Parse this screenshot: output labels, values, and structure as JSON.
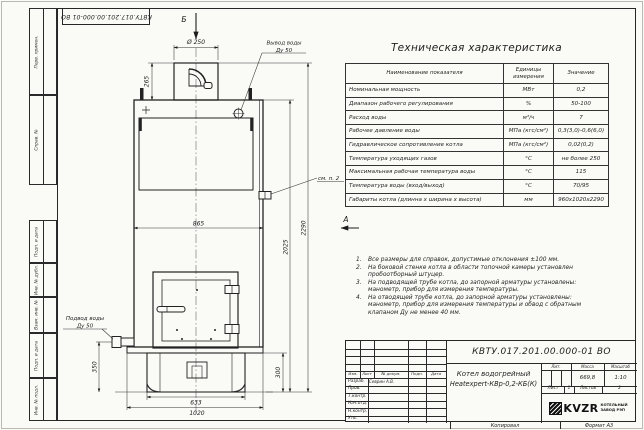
{
  "sheet": {
    "stamp_number": "КВТУ.017.201.00.000-01 ВО",
    "copied_label": "Копировал",
    "format_label": "Формат А3",
    "frame_fields": [
      "Перв. примен.",
      "Справ. №",
      "Подп. и дата",
      "Инв. № дубл.",
      "Взам. инв. №",
      "Подп. и дата",
      "Инв. № подл."
    ]
  },
  "drawing": {
    "view_b": "Б",
    "view_a": "А",
    "outlet_line1": "Вывод воды",
    "outlet_line2": "Ду 50",
    "inlet_line1": "Подвод воды",
    "inlet_line2": "Ду 50",
    "see_note": "см. п. 2",
    "dims": {
      "chimney_dia": "Ø 250",
      "chimney_height": "265",
      "body_width": "865",
      "body_height": "2025",
      "total_height": "2290",
      "inlet_height": "350",
      "base_height": "300",
      "base_width": "633",
      "plate_width": "1020"
    }
  },
  "tech_table": {
    "title": "Техническая характеристика",
    "headers": [
      "Наименование показателя",
      "Единицы измерения",
      "Значение"
    ],
    "rows": [
      [
        "Номинальная мощность",
        "МВт",
        "0,2"
      ],
      [
        "Диапазон рабочего регулирования",
        "%",
        "50-100"
      ],
      [
        "Расход воды",
        "м³/ч",
        "7"
      ],
      [
        "Рабочее давление воды",
        "МПа (кгс/см²)",
        "0,3(3,0)-0,6(6,0)"
      ],
      [
        "Гидравлическое сопротивление котла",
        "МПа (кгс/см²)",
        "0,02(0,2)"
      ],
      [
        "Температура уходящих газов",
        "°С",
        "не более 250"
      ],
      [
        "Максимальная рабочая температура воды",
        "°С",
        "115"
      ],
      [
        "Температура воды (вход/выход)",
        "°С",
        "70/95"
      ],
      [
        "Габариты котла (длинна х ширина х высота)",
        "мм",
        "960х1020х2290"
      ]
    ]
  },
  "notes": {
    "items": [
      {
        "num": "1.",
        "text": "Все размеры для справок, допустимые отклонения ±100 мм."
      },
      {
        "num": "2.",
        "text": "На боковой стенке котла в области топочной камеры установлен пробоотборный штуцер."
      },
      {
        "num": "3.",
        "text": "На подводящей трубе котла, до запорной арматуры установлены: манометр, прибор для измерения температуры."
      },
      {
        "num": "4.",
        "text": "На отводящей трубе котла, до запорной арматуры установлены: манометр, прибор для измерения температуры и обвод с обратным клапаном Ду не менее 40 мм."
      }
    ]
  },
  "title_block": {
    "doc_number": "КВТУ.017.201.00.000-01 ВО",
    "name_line1": "Котел водогрейный",
    "name_line2": "Heatexpert-КВр-0,2-КБ(К)",
    "col_headers": [
      "Изм.",
      "Лист",
      "№ докум.",
      "Подп.",
      "Дата"
    ],
    "staff_labels": [
      "Разраб.",
      "Пров.",
      "Т.контр.",
      "Нач.отд.",
      "Н.контр.",
      "Утв."
    ],
    "designer_name": "Севрин А.В.",
    "lit_label": "Лит.",
    "mass_label": "Масса",
    "scale_label": "Масштаб",
    "mass_value": "669,8",
    "scale_value": "1:10",
    "sheet_label": "Лист",
    "sheet_value": "1",
    "sheets_label": "Листов",
    "sheets_value": "2",
    "brand": "KVZR",
    "company_line1": "КОТЕЛЬНЫЙ",
    "company_line2": "ЗАВОД РЭП"
  }
}
